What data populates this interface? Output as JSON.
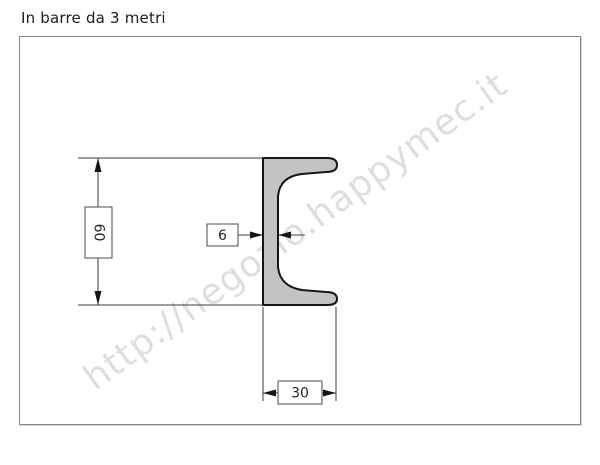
{
  "title": "In barre da 3 metri",
  "watermark": "http://negozio.happymec.it",
  "drawing": {
    "type": "technical-cross-section",
    "profile_shape": "U-channel (C profile) opening to the right",
    "dimensions": {
      "height": "60",
      "web_thickness": "6",
      "flange_width": "30"
    }
  },
  "colors": {
    "profile_fill": "#c3c3c3",
    "profile_outline": "#161616",
    "dimension_lines": "#3d3d3d",
    "dimension_box_border": "#4a4a4a",
    "frame_border": "#868686",
    "watermark": "#dedede",
    "background": "#ffffff"
  }
}
